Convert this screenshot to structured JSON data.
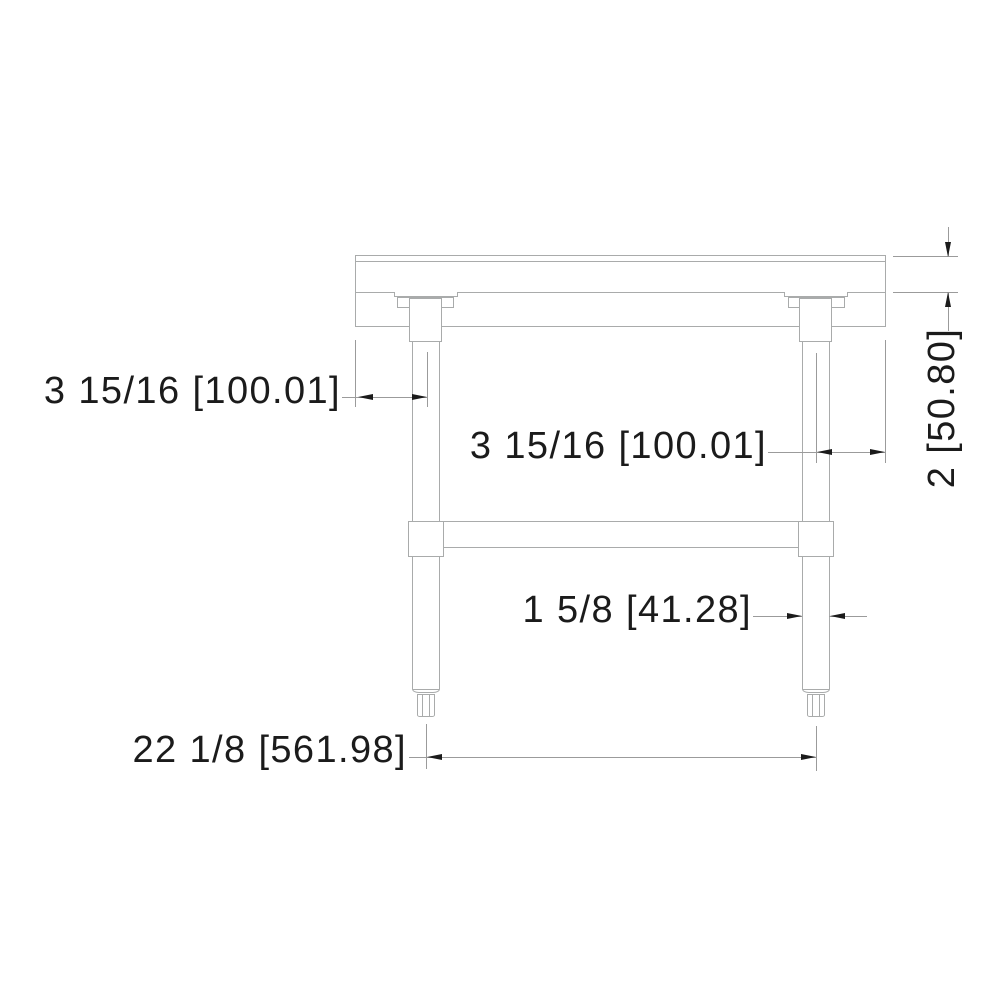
{
  "drawing": {
    "type": "technical side-elevation drawing of an equipment stand table",
    "dimensions": {
      "left_leg_offset": {
        "label": "3 15/16 [100.01]",
        "orientation": "horizontal"
      },
      "right_leg_offset": {
        "label": "3 15/16 [100.01]",
        "orientation": "horizontal"
      },
      "top_thickness": {
        "label": "2 [50.80]",
        "orientation": "vertical"
      },
      "leg_diameter": {
        "label": "1 5/8 [41.28]",
        "orientation": "horizontal"
      },
      "leg_spacing": {
        "label": "22 1/8 [561.98]",
        "orientation": "horizontal"
      }
    },
    "colors": {
      "background": "#ffffff",
      "geometry_line": "#a9abab",
      "dimension_line": "#9b9b9b",
      "text_and_arrows": "#1b1b1b"
    }
  }
}
